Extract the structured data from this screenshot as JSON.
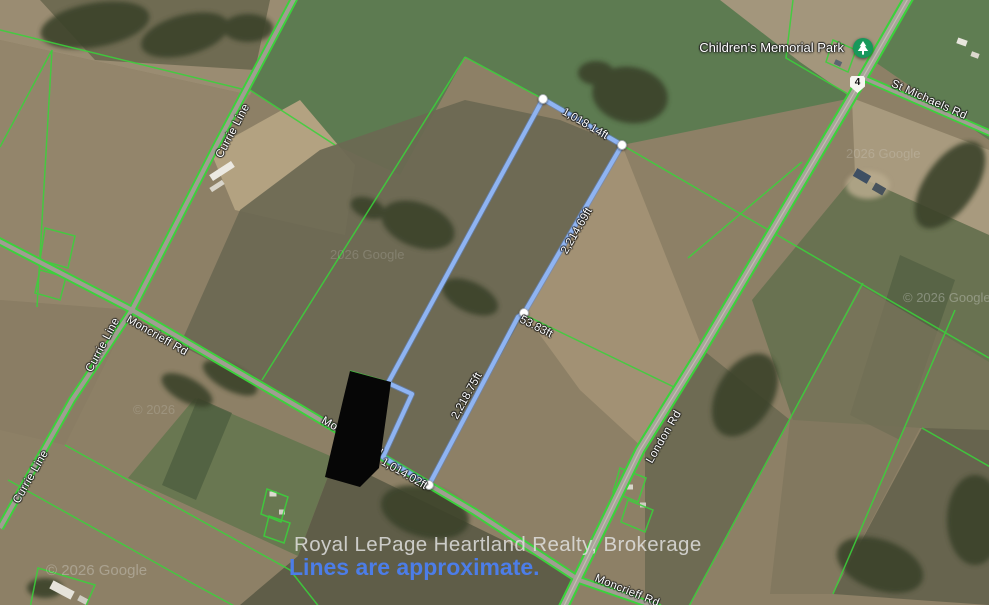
{
  "map": {
    "poi": {
      "park_label": "Children's Memorial Park"
    },
    "highway_shield": "4",
    "road_labels": {
      "currie_line": "Currie Line",
      "moncrieff_rd": "Moncrieff Rd",
      "london_rd": "London Rd",
      "st_michaels_rd": "St Michaels Rd"
    },
    "measurements": {
      "top_edge": "1,018.14ft",
      "northeast_edge": "2,214.69ft",
      "jog": "53.83ft",
      "southeast_edge": "2,218.75ft",
      "bottom_edge": "1,014.02ft"
    },
    "watermarks": {
      "copyright": "© 2026 Google",
      "plain": "2026 Google",
      "short": "© 2026"
    },
    "footer": {
      "attribution": "Royal LePage Heartland Realty, Brokerage",
      "disclaimer": "Lines are approximate."
    },
    "colors": {
      "parcel_line_green": "#3bd23b",
      "boundary_blue": "#8fb4f2",
      "disclaimer_blue": "#4c7de8",
      "park_marker_green": "#17985b"
    }
  }
}
